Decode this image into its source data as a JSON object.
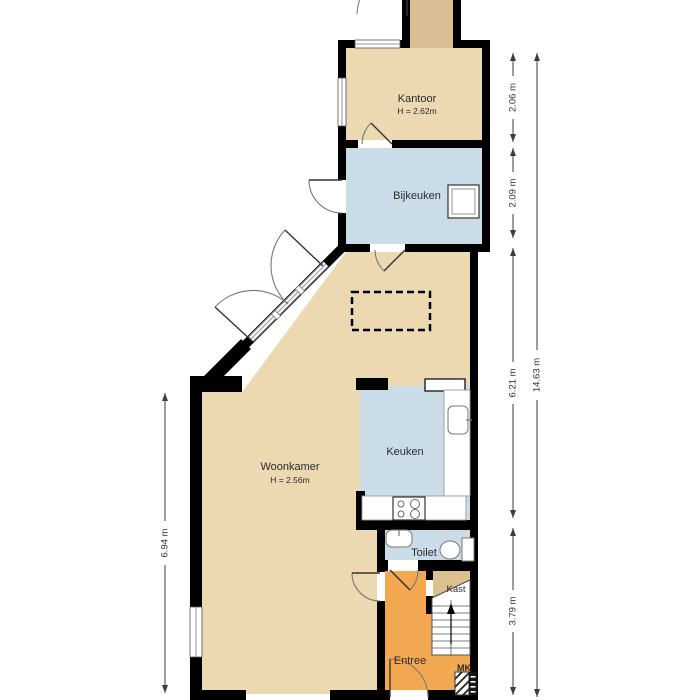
{
  "labels": {
    "kantoor": "Kantoor",
    "kantoor_height": "H = 2.62m",
    "bijkeuken": "Bijkeuken",
    "woonkamer": "Woonkamer",
    "woonkamer_height": "H = 2.56m",
    "keuken": "Keuken",
    "toilet": "Toilet",
    "kast": "Kast",
    "entree": "Entree",
    "mk": "MK"
  },
  "dimensions": {
    "d1": "2.06 m",
    "d2": "2.09 m",
    "d3": "6.21 m",
    "d4": "3.79 m",
    "total": "14.63 m",
    "left": "6.94 m"
  },
  "colors": {
    "room_tan": "#ECD9B2",
    "annex_tan": "#D9BE94",
    "kast_tan": "#DCC18F",
    "wet_room_blue": "#CBDCE9",
    "hall_orange": "#F2A851",
    "wall_black": "#000000",
    "dimension_gray": "#3C3C3C"
  }
}
